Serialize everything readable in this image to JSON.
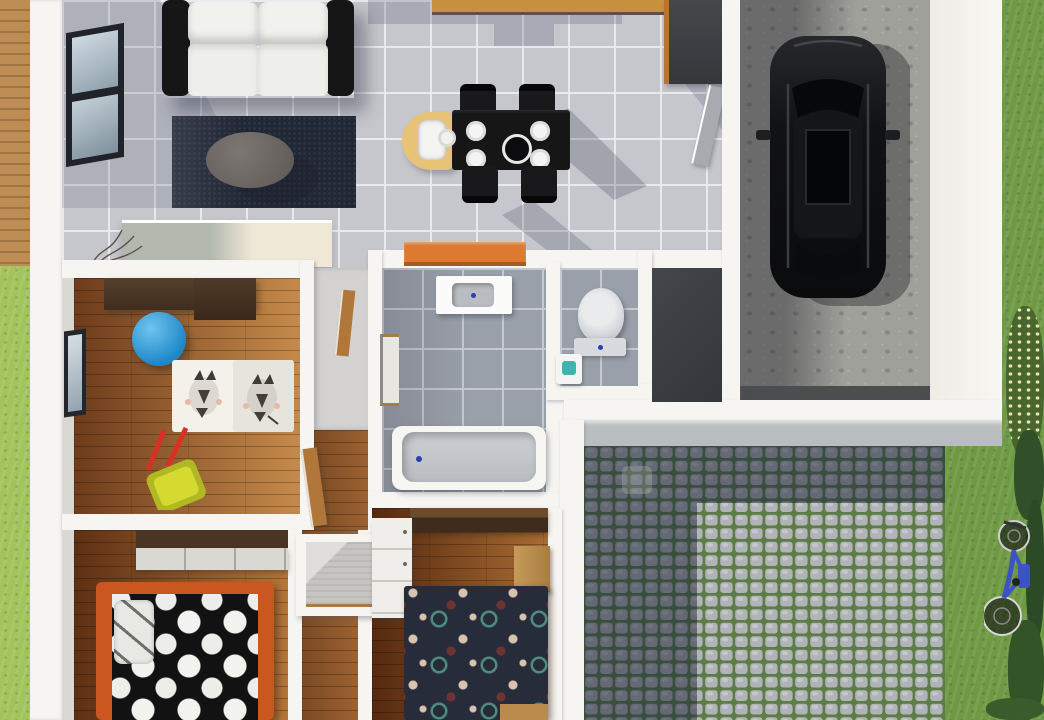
{
  "scene": {
    "image_type": "photorealistic top-down 3D render of a house floor plan",
    "rooms": [
      {
        "name": "living-room",
        "floor": "light gray tile",
        "objects": [
          "black-frame sofa with white cushions",
          "dark navy rug",
          "gray oval coffee table",
          "tv sideboard",
          "decorative twigs",
          "black-framed window on left wall"
        ]
      },
      {
        "name": "kitchen-dining",
        "floor": "light gray tile",
        "objects": [
          "wood countertop at top edge",
          "tall dark cabinet",
          "black dining table",
          "4 white plates",
          "black centerpiece bowl",
          "4 black chairs",
          "wooden baby high chair",
          "orange bench",
          "gray door to garage"
        ]
      },
      {
        "name": "garage",
        "floor": "concrete",
        "objects": [
          "black SUV seen from above with sunroof",
          "dark entrance threshold strip"
        ]
      },
      {
        "name": "kids-room",
        "floor": "brown wood planks",
        "objects": [
          "dark walnut wardrobe",
          "blue gym ball",
          "white zebra-pattern rug",
          "yellow toy wheelbarrow with red handles",
          "window on left wall"
        ]
      },
      {
        "name": "bathroom",
        "floor": "blue-gray tile",
        "objects": [
          "white vanity with sink",
          "wall mirror",
          "bathtub with drain"
        ]
      },
      {
        "name": "wc",
        "floor": "blue-gray tile",
        "objects": [
          "toilet",
          "small washbasin with teal detail"
        ]
      },
      {
        "name": "storage-room",
        "floor": "dark charcoal"
      },
      {
        "name": "hallway",
        "floor": "wood planks",
        "objects": [
          "white closet niche with gray interior",
          "open wood doors"
        ]
      },
      {
        "name": "bedroom-1",
        "floor": "wood planks",
        "objects": [
          "wardrobe with light sliding front",
          "bed with orange frame",
          "black duvet with white polka dots",
          "light pillow"
        ]
      },
      {
        "name": "bedroom-2",
        "floor": "wood planks",
        "objects": [
          "dark wood wardrobe",
          "white dresser",
          "light wood bench headboard",
          "navy duvet with teal rings and cream/maroon dots",
          "wood footboard"
        ]
      }
    ],
    "outdoor": [
      {
        "name": "wood-deck",
        "position": "top-left edge"
      },
      {
        "name": "grass-strip",
        "position": "left edge"
      },
      {
        "name": "cobblestone-patio",
        "detail": "stone pavers with mossy joints, left and top portion in building shadow"
      },
      {
        "name": "garden",
        "position": "right side",
        "objects": [
          "blue bicycle lying on grass",
          "dark bushes along right edge",
          "flowering shrub"
        ]
      }
    ],
    "palette": {
      "wall": "#f7f5f1",
      "tile": "#c6c7cc",
      "grout": "#e9eaee",
      "btile": "#9aa0a9",
      "bgrout": "#c6c9d0",
      "grassLight": "#a3c45c",
      "grassDark": "#6f9a44",
      "bushDark": "#31502a",
      "concrete": "#a0a09b",
      "cobble": "#b0b3b7",
      "moss": "#5d7c47",
      "ledge": "#babdbf",
      "woodDeck": "#b5854f",
      "walnut": "#4a3424",
      "woodLight": "#c8913f",
      "sofaBlack": "#161616",
      "cushion": "#f1f1ee",
      "rug": "#202735",
      "tableGray": "#6f6a66",
      "orange": "#dd7a30",
      "ballBlue": "#2f9ed9",
      "bedOrange": "#c9571f",
      "duvetBlack": "#121212",
      "duvetNavy": "#272c3a",
      "tealRing": "#4f8c7e",
      "cream": "#d8c2b0",
      "maroon": "#6e3434",
      "bikeBlue": "#3d52c4",
      "carBlack": "#0e0f11",
      "charcoal": "#3c4043",
      "doorGray": "#a7abb0",
      "blueDot": "#2b3fb0"
    }
  }
}
